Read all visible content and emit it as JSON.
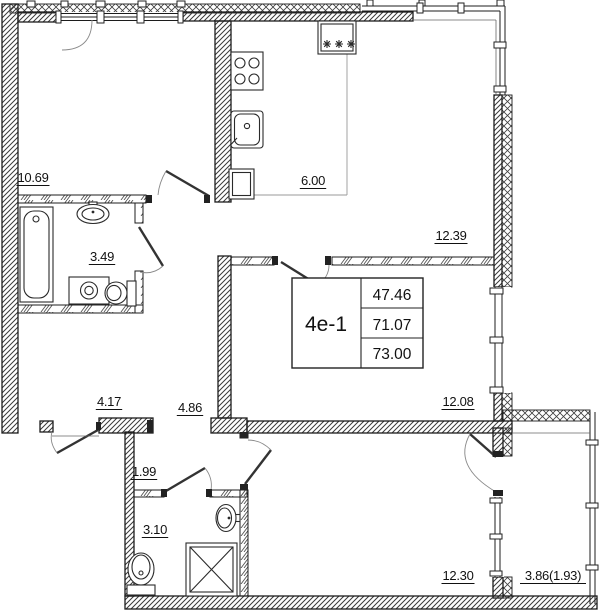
{
  "title": "apartment-floor-plan",
  "unit": {
    "label": "4е-1",
    "living_area": "47.46",
    "area_excl_balcony": "71.07",
    "total_area": "73.00"
  },
  "rooms": [
    {
      "id": "bedroom-top-left",
      "label": "10.69",
      "x": 33,
      "y": 182
    },
    {
      "id": "bathroom-main",
      "label": "3.49",
      "x": 102,
      "y": 261
    },
    {
      "id": "hallway-left",
      "label": "4.17",
      "x": 109,
      "y": 406
    },
    {
      "id": "corridor-center",
      "label": "4.86",
      "x": 190,
      "y": 412
    },
    {
      "id": "hall-small",
      "label": "1.99",
      "x": 144,
      "y": 476
    },
    {
      "id": "bathroom-second",
      "label": "3.10",
      "x": 155,
      "y": 534
    },
    {
      "id": "kitchen-zone",
      "label": "6.00",
      "x": 313,
      "y": 185
    },
    {
      "id": "living-dining-zone",
      "label": "12.39",
      "x": 451,
      "y": 240
    },
    {
      "id": "bedroom-middle",
      "label": "12.08",
      "x": 458,
      "y": 406
    },
    {
      "id": "bedroom-bottom",
      "label": "12.30",
      "x": 458,
      "y": 580
    },
    {
      "id": "balcony",
      "label": "3.86(1.93)",
      "x": 553,
      "y": 580
    }
  ],
  "icons": {
    "ventilation-shaft": "✳✳✳"
  },
  "colors": {
    "background": "#ffffff",
    "wall_stroke": "#1c1c1c",
    "hatch": "#3a3a3a",
    "door_swing": "#8a8a8a"
  }
}
